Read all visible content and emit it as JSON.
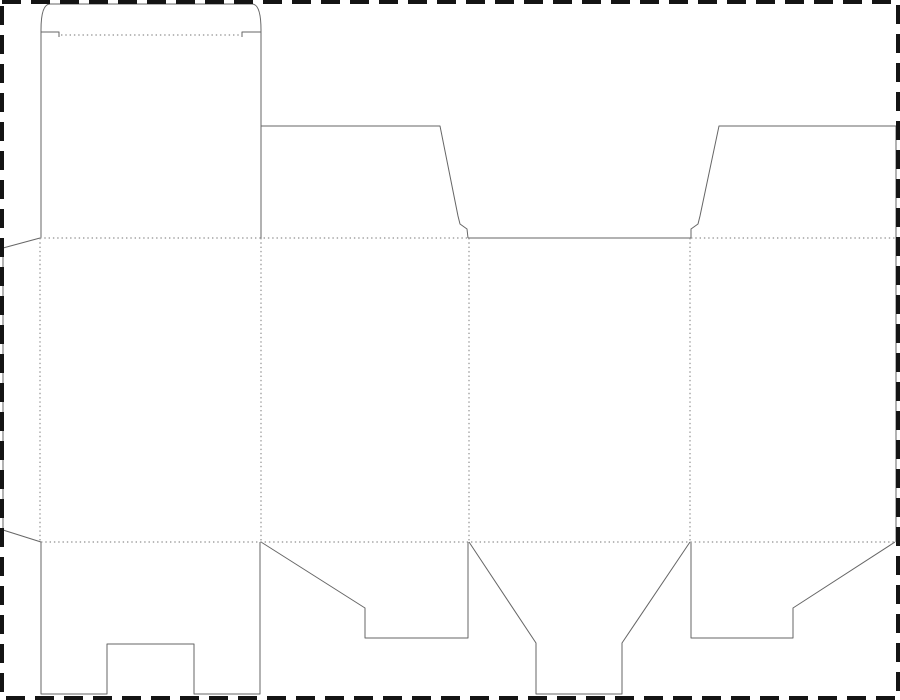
{
  "canvas": {
    "width": 900,
    "height": 700,
    "background": "#ffffff",
    "description": "Box packaging dieline template: solid gray lines are cut lines, dotted gray lines are fold lines, black dashed frame is the sheet boundary"
  },
  "styles": {
    "cut": {
      "color": "#666666",
      "width": 1,
      "dasharray": ""
    },
    "fold": {
      "color": "#8f8f8f",
      "width": 1.2,
      "dasharray": "1.4 2.9"
    },
    "border": {
      "color": "#141414",
      "width": 4,
      "dasharray": "19 10"
    }
  },
  "sheet_border": {
    "x": 2,
    "y": 2,
    "width": 896,
    "height": 696
  },
  "panels": {
    "glue_flap_x": [
      3,
      40
    ],
    "columns_x": [
      40,
      261,
      469,
      690,
      896
    ],
    "body_rows_y": [
      238,
      542
    ]
  },
  "lines": [
    {
      "name": "tuck-lid-outline",
      "type": "cut",
      "d": "M 41,238 L 41,30 Q 41,4 50,4 L 252,4 Q 261,4 261,30 L 261,238"
    },
    {
      "name": "tuck-shoulder-left",
      "type": "cut",
      "d": "M 41,32 L 59,32 L 59,37"
    },
    {
      "name": "tuck-shoulder-right",
      "type": "cut",
      "d": "M 261,32 L 242,32 L 242,37"
    },
    {
      "name": "top-dust-flap-left",
      "type": "cut",
      "d": "M 261,126 L 440,126 L 458,216 L 460,224 L 467,229 L 468,238"
    },
    {
      "name": "top-middle-cut-edge",
      "type": "cut",
      "d": "M 468,238 L 691,238"
    },
    {
      "name": "top-dust-flap-right",
      "type": "cut",
      "d": "M 691,238 L 691,229 L 698,224 L 700,216 L 719,126 L 896,126"
    },
    {
      "name": "right-sheet-cut-edge",
      "type": "cut",
      "d": "M 896,126 L 896,542"
    },
    {
      "name": "glue-flap-outline",
      "type": "cut",
      "d": "M 40,238 L 3,248 L 3,530 L 41,542"
    },
    {
      "name": "bottom-tuck-flap-notched",
      "type": "cut",
      "d": "M 41,542 L 41,694 L 107,694 L 107,644 L 194,644 L 194,694 L 260,694 L 260,542"
    },
    {
      "name": "bottom-flap-left-angled",
      "type": "cut",
      "d": "M 261,542 L 365,608 L 365,638 L 468,638 L 468,542"
    },
    {
      "name": "bottom-funnel-flap",
      "type": "cut",
      "d": "M 469,542 L 536,643 L 536,694 L 622,694 L 622,643 L 690,542"
    },
    {
      "name": "bottom-flap-right-angled",
      "type": "cut",
      "d": "M 691,542 L 691,638 L 793,638 L 793,608 L 895,542"
    },
    {
      "name": "tuck-lid-fold",
      "type": "fold",
      "d": "M 61,35 L 240,35"
    },
    {
      "name": "top-fold-row-left",
      "type": "fold",
      "d": "M 40,238 L 468,238"
    },
    {
      "name": "top-fold-row-right",
      "type": "fold",
      "d": "M 691,238 L 896,238"
    },
    {
      "name": "bottom-fold-row",
      "type": "fold",
      "d": "M 41,542 L 895,542"
    },
    {
      "name": "vertical-fold-glue",
      "type": "fold",
      "d": "M 40,238 L 40,542"
    },
    {
      "name": "vertical-fold-panel-1-2",
      "type": "fold",
      "d": "M 261,238 L 261,542"
    },
    {
      "name": "vertical-fold-panel-2-3",
      "type": "fold",
      "d": "M 469,238 L 469,542"
    },
    {
      "name": "vertical-fold-panel-3-4",
      "type": "fold",
      "d": "M 690,238 L 690,542"
    }
  ]
}
